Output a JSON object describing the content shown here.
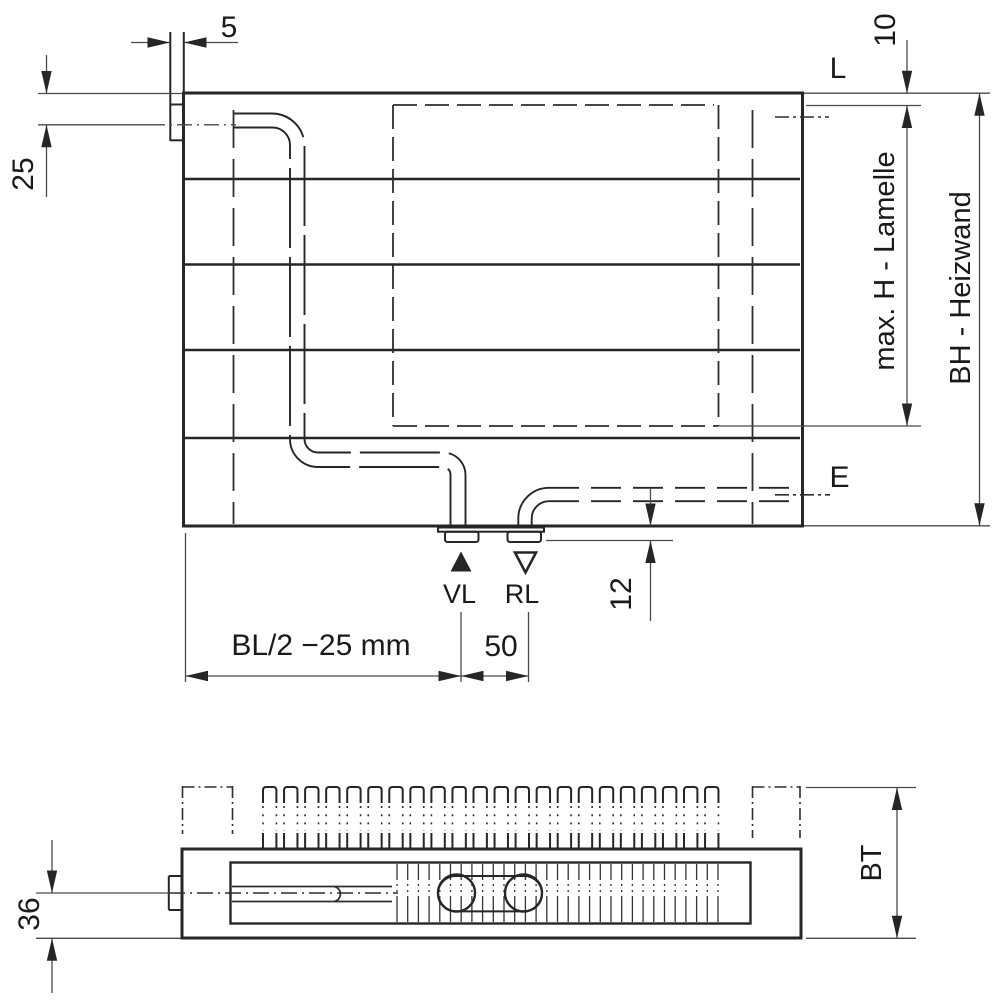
{
  "front_view": {
    "dims": {
      "tab_width": "5",
      "top_to_pipe_center": "25",
      "top_to_lamelle": "10",
      "lamelle_max_height": "max. H - Lamelle",
      "build_height": "BH - Heizwand",
      "stub_protrusion": "12",
      "edge_to_supply": "BL/2 −25 mm",
      "supply_to_return": "50"
    },
    "labels": {
      "vent": "L",
      "drain": "E",
      "supply": "VL",
      "return": "RL"
    }
  },
  "top_view": {
    "dims": {
      "center_to_face": "36",
      "build_depth": "BT"
    }
  }
}
